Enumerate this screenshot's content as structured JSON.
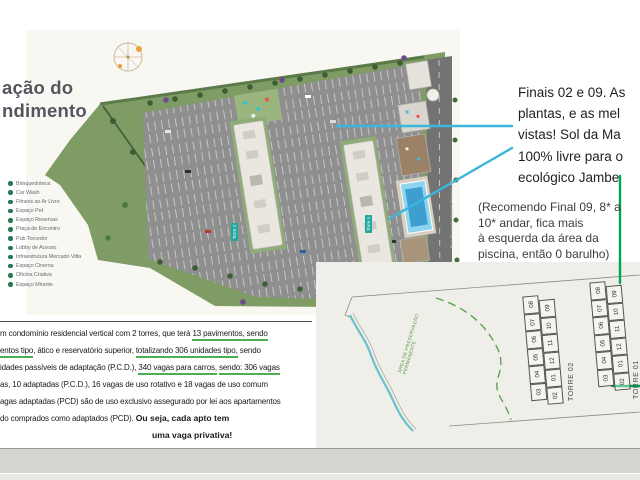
{
  "title": {
    "line1": "ação do",
    "line2": "ndimento"
  },
  "legend": {
    "items": [
      "Brinquedoteca",
      "Car Wash",
      "Fitness ao Ar Livre",
      "Espaço Pet",
      "Espaço Reservas",
      "Praça de Encontro",
      "Pub Torcedor",
      "Lobby de Acesso",
      "Infraestrutura Mercado Vitta",
      "Espaço Cinema",
      "Oficina Criativa",
      "Espaço Mirante"
    ]
  },
  "site_plan": {
    "tower1_label": "Torre 1",
    "tower2_label": "Torre 2",
    "street_label": "Rua Recanto Miguel Pereira 300"
  },
  "callout": {
    "lines": [
      "Finais 02 e 09. As",
      "plantas, e as mel",
      "vistas! Sol da Ma",
      "100% livre para o",
      "ecológico Jambe"
    ]
  },
  "note": {
    "lines": [
      "(Recomendo Final 09, 8* a",
      "10* andar, fica mais",
      "à esquerda da área da",
      "piscina, então 0 barulho)"
    ]
  },
  "description": {
    "l1a": "m condomínio residencial vertical com 2 torres, que terá ",
    "l1b": "13 pavimentos, sendo",
    "l2a": "entos tipo",
    "l2b": ", ático e reservatório superior, ",
    "l2c": "totalizando 306 unidades tipo,",
    "l2d": " sendo",
    "l3a": "idades passíveis de adaptação (P.C.D.), ",
    "l3b": "340 vagas para carros,",
    "l3c": " ",
    "l3d": "sendo: 306 vagas",
    "l4": "as, 10 adaptadas (P.C.D.), 16 vagas de uso rotativo e 18 vagas de uso comum",
    "l5": "agas adaptadas (PCD) são de uso exclusivo assegurado por lei aos apartamentos",
    "l6a": "do comprados como adaptados (PCD). ",
    "l6b": "Ou seja, cada apto tem",
    "l7": "uma vaga privativa!"
  },
  "floor_plan": {
    "tower02_label": "TORRE 02",
    "tower01_label": "TORRE 01",
    "apa_line1": "ÁREA DE PRESERVAÇÃO",
    "apa_line2": "PERMANENTE",
    "left_column": [
      "08",
      "07",
      "06",
      "05",
      "04",
      "03"
    ],
    "right_column": [
      "09",
      "10",
      "11",
      "12",
      "01",
      "02"
    ]
  },
  "colors": {
    "cyan_annotation": "#3ab7dc",
    "green_annotation": "#00a550",
    "underline_green": "#4caf50",
    "site_green": "#7e9c64",
    "parking_gray": "#8f8f8f",
    "tower_tag_teal": "#1fa9a0",
    "pool_blue": "#3e9ed0",
    "title_slate": "#55555e"
  }
}
